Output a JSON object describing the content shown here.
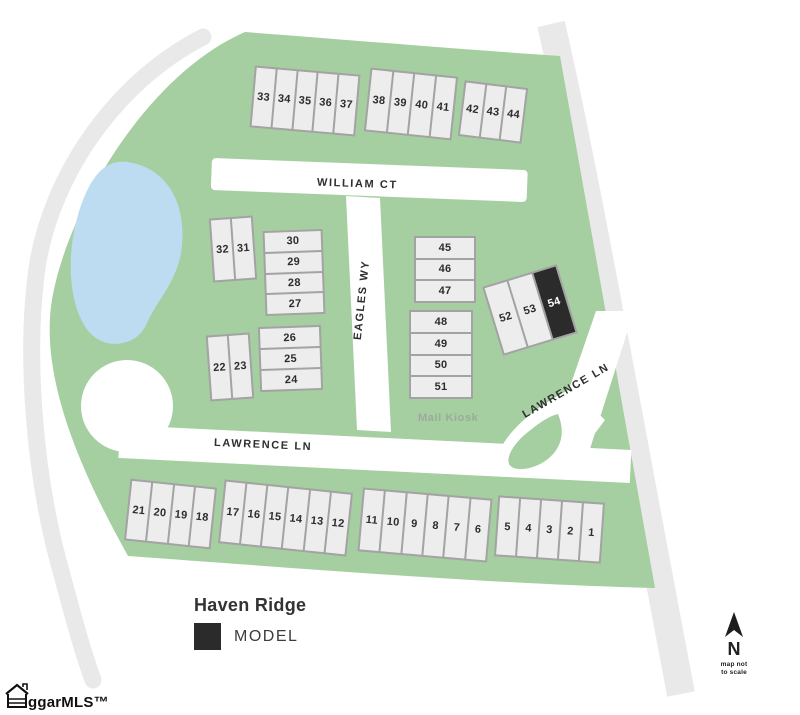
{
  "title": "Haven Ridge",
  "legend": {
    "model_label": "MODEL"
  },
  "streets": {
    "william_ct": "WILLIAM CT",
    "eagles_wy": "EAGLES WY",
    "lawrence_ln_west": "LAWRENCE LN",
    "lawrence_ln_east": "LAWRENCE LN"
  },
  "labels": {
    "mail_kiosk": "Mail Kiosk"
  },
  "compass": {
    "letter": "N",
    "note_line1": "map not",
    "note_line2": "to scale"
  },
  "watermark": "ggarMLS™",
  "colors": {
    "green": "#a5cfa0",
    "pond": "#bddcf1",
    "road": "#ffffff",
    "outer_band": "#e9e9e9",
    "lot_fill": "#ededed",
    "lot_border": "#a3a3a3",
    "model_fill": "#2b2b2b",
    "text": "#2e2e2e",
    "kiosk_text": "#9cab9b"
  },
  "model_lots": [
    "54"
  ],
  "lot_groups": [
    {
      "id": "row-33-37",
      "lots": [
        "33",
        "34",
        "35",
        "36",
        "37"
      ]
    },
    {
      "id": "row-38-41",
      "lots": [
        "38",
        "39",
        "40",
        "41"
      ]
    },
    {
      "id": "row-42-44",
      "lots": [
        "42",
        "43",
        "44"
      ]
    },
    {
      "id": "pair-32-31",
      "lots": [
        "32",
        "31"
      ]
    },
    {
      "id": "stack-30-27",
      "lots": [
        "30",
        "29",
        "28",
        "27"
      ]
    },
    {
      "id": "stack-26-24",
      "lots": [
        "26",
        "25",
        "24"
      ]
    },
    {
      "id": "pair-22-23",
      "lots": [
        "22",
        "23"
      ]
    },
    {
      "id": "stack-45-47",
      "lots": [
        "45",
        "46",
        "47"
      ]
    },
    {
      "id": "stack-48-51",
      "lots": [
        "48",
        "49",
        "50",
        "51"
      ]
    },
    {
      "id": "trio-52-54",
      "lots": [
        "52",
        "53",
        "54"
      ]
    },
    {
      "id": "row-21-18",
      "lots": [
        "21",
        "20",
        "19",
        "18"
      ]
    },
    {
      "id": "row-17-12",
      "lots": [
        "17",
        "16",
        "15",
        "14",
        "13",
        "12"
      ]
    },
    {
      "id": "row-11-6",
      "lots": [
        "11",
        "10",
        "9",
        "8",
        "7",
        "6"
      ]
    },
    {
      "id": "row-5-1",
      "lots": [
        "5",
        "4",
        "3",
        "2",
        "1"
      ]
    }
  ]
}
